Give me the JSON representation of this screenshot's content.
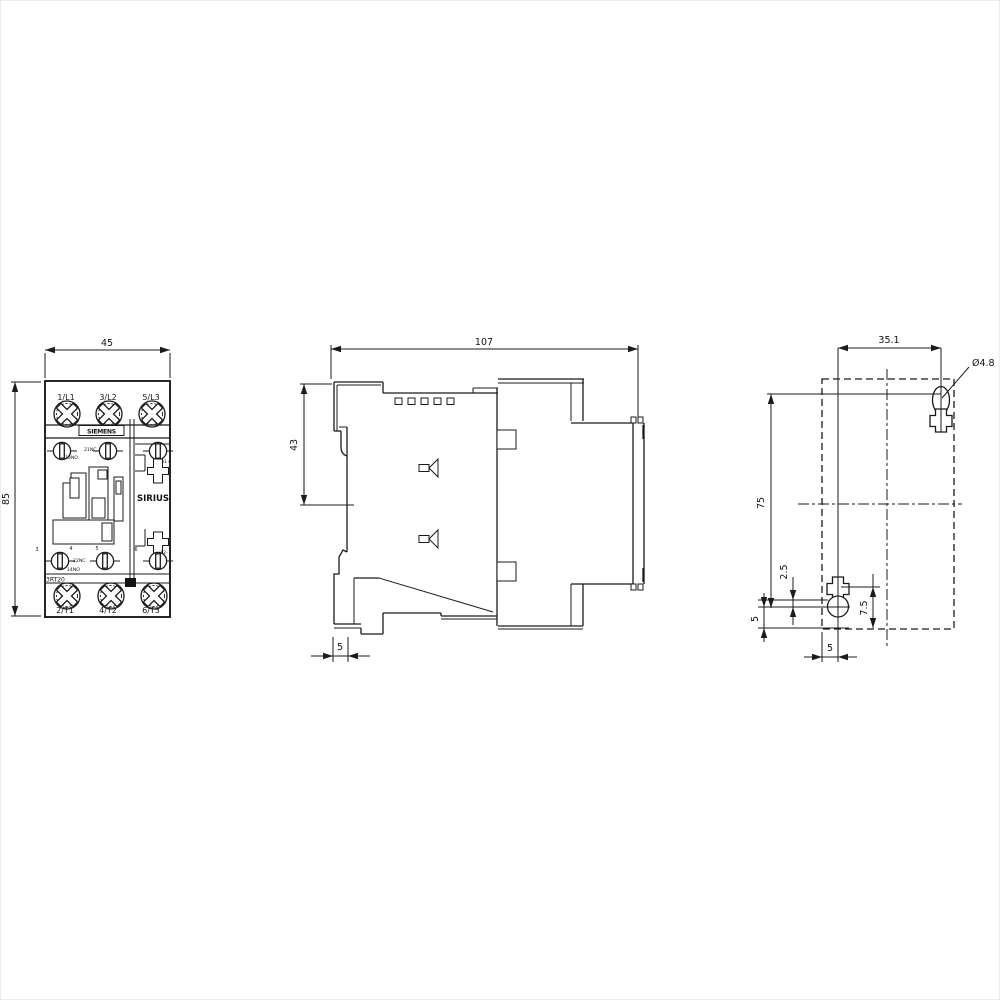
{
  "front_view": {
    "width": "45",
    "height": "85",
    "brand": "SIEMENS",
    "series": "SIRIUS",
    "product_code": "3RT20",
    "top_terminals": [
      "1/L1",
      "3/L2",
      "5/L3"
    ],
    "bottom_terminals": [
      "2/T1",
      "4/T2",
      "6/T3"
    ],
    "aux_labels": {
      "top_no": "13NO",
      "top_nc": "21NC",
      "coil_plus": "A1+",
      "bottom_no": "14NO",
      "bottom_nc": "22NC",
      "coil_minus": "A2-"
    },
    "terminal_numbers": [
      "3",
      "4",
      "5",
      "6"
    ]
  },
  "side_view": {
    "width": "107",
    "din_clip_height": "43",
    "bottom_offset": "5"
  },
  "drill_plan": {
    "hole_spacing_horizontal": "35.1",
    "hole_diameter": "Ø4.8",
    "hole_spacing_vertical": "75",
    "offset_top": "2.5",
    "slot_length": "7.5",
    "offset_left": "5",
    "offset_bottom": "5"
  }
}
